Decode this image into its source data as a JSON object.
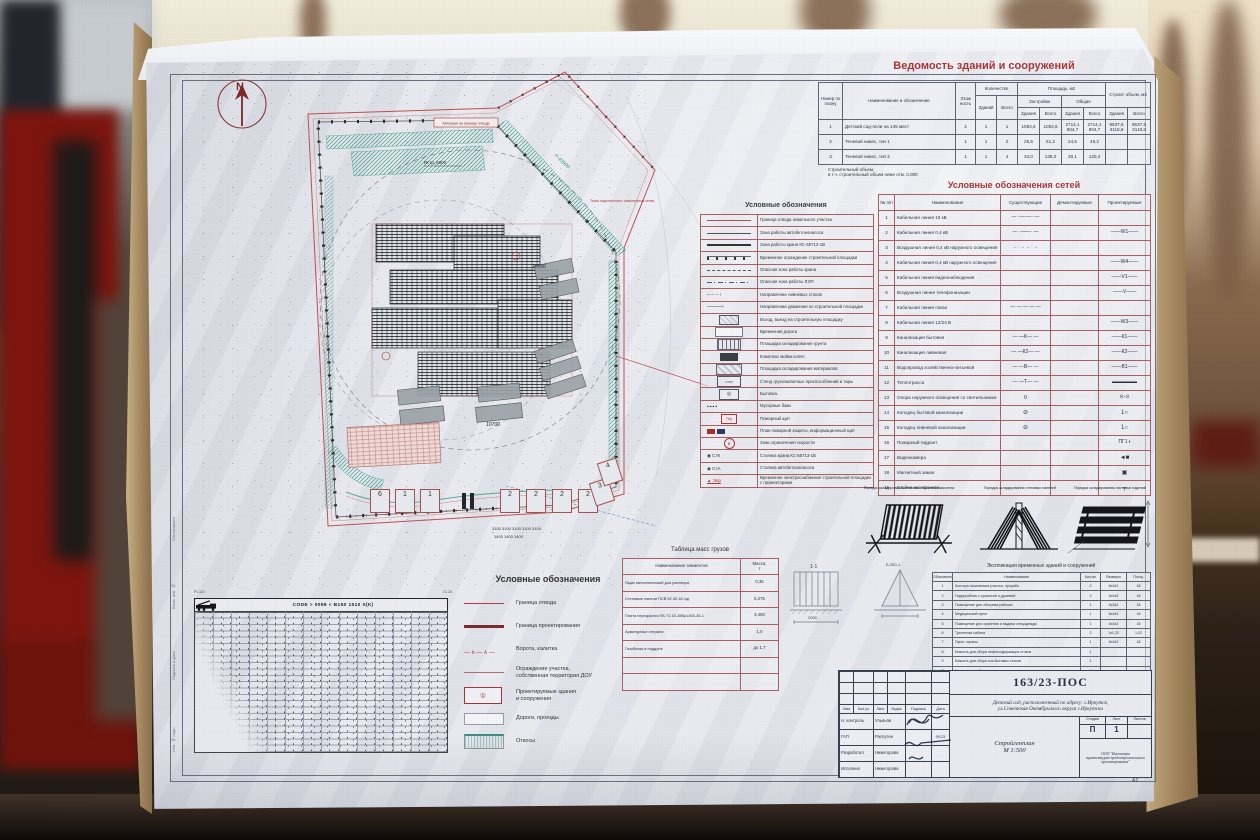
{
  "colors": {
    "accent_red": "#b03434",
    "line_red": "#c0504d",
    "teal": "#2f8f7f",
    "paper": "#e7e9ef"
  },
  "buildings_table": {
    "title": "Ведомость зданий и сооружений",
    "header": {
      "num": "Номер по плану",
      "name": "Наименование и обозначение",
      "floors": "Этаж ность",
      "qty": "Количество",
      "qty_bld": "Зданий",
      "qty_all": "Всего",
      "area": "Площадь, м2",
      "area_built": "Застройки",
      "area_total": "Общая",
      "bld": "Здания",
      "all": "Всего",
      "vol": "Строит. объем, м3"
    },
    "rows": [
      {
        "n": "1",
        "name": "Детский сад-ясли на 145 мест",
        "fl": "2",
        "qb": "1",
        "qa": "1",
        "zb": "1053,6",
        "za": "1053,6",
        "ob": "2714,1\n904,7",
        "oa": "2714,1\n904,7",
        "vb": "9637,6\n3118,8",
        "va": "9637,6\n3118,8"
      },
      {
        "n": "2",
        "name": "Теневой навес, тип 1",
        "fl": "1",
        "qb": "1",
        "qa": "2",
        "zb": "25,6",
        "za": "51,2",
        "ob": "24,6",
        "oa": "49,2",
        "vb": "",
        "va": ""
      },
      {
        "n": "3",
        "name": "Теневой навес, тип 2",
        "fl": "1",
        "qb": "1",
        "qa": "4",
        "zb": "34,0",
        "za": "136,0",
        "ob": "30,1",
        "oa": "120,4",
        "vb": "",
        "va": ""
      }
    ],
    "note": "Строительный объем,\nв т.ч. строительный объем ниже отм. 0.000"
  },
  "networks_table": {
    "title": "Условные обозначения сетей",
    "header": {
      "n": "№ п/п",
      "name": "Наименование",
      "ex": "Существующие",
      "dem": "Демонтируемые",
      "pr": "Проектируемые"
    },
    "rows": [
      {
        "n": "1",
        "name": "Кабельная линия 10 кВ",
        "ex": "— ·—·—· —",
        "pr": ""
      },
      {
        "n": "2",
        "name": "Кабельная линия 0,4 кВ",
        "ex": "— ·——· —",
        "pr": "——W1——"
      },
      {
        "n": "3",
        "name": "Воздушная линия 0,4 кВ наружного освещения",
        "ex": "←·→  ←·→",
        "pr": ""
      },
      {
        "n": "4",
        "name": "Кабельная линия 0,4 кВ наружного освещения",
        "ex": "",
        "pr": "——W4——"
      },
      {
        "n": "5",
        "name": "Кабельная линия видеонаблюдения",
        "ex": "",
        "pr": "——V1——"
      },
      {
        "n": "6",
        "name": "Воздушная линия телефонизации",
        "ex": "",
        "pr": "——V——"
      },
      {
        "n": "7",
        "name": "Кабельная линия связи",
        "ex": "— — — — —",
        "pr": ""
      },
      {
        "n": "8",
        "name": "Кабельная линия 12/24 В",
        "ex": "",
        "pr": "——W3——"
      },
      {
        "n": "9",
        "name": "Канализация бытовая",
        "ex": "— —К— —",
        "pr": "——К1——"
      },
      {
        "n": "10",
        "name": "Канализация ливневая",
        "ex": "— —К2— —",
        "pr": "——К2——"
      },
      {
        "n": "11",
        "name": "Водопровод хозяйственно-питьевой",
        "ex": "— —В— —",
        "pr": "——В1——"
      },
      {
        "n": "12",
        "name": "Теплотрасса",
        "ex": "— —Т— —",
        "pr": "▬▬▬▬▬",
        "prc": "pr-red"
      },
      {
        "n": "13",
        "name": "Опора наружного освещения со светильником",
        "ex": "¤",
        "exc": "ex-dark",
        "pr": "⊙-⊙",
        "prc": "pr-red"
      },
      {
        "n": "14",
        "name": "Колодец бытовой канализации",
        "ex": "⊘",
        "exc": "ex-dark",
        "pr": "1○",
        "prc": "pr-dark"
      },
      {
        "n": "15",
        "name": "Колодец ливневой канализации",
        "ex": "⊖",
        "exc": "ex-dark",
        "pr": "1○",
        "prc": "pr-dark"
      },
      {
        "n": "16",
        "name": "Пожарный гидрант",
        "ex": "",
        "pr": "ПГ1◑",
        "prc": "pr-red"
      },
      {
        "n": "17",
        "name": "Видеокамера",
        "ex": "",
        "pr": "◄■",
        "prc": "pr-dark"
      },
      {
        "n": "18",
        "name": "Магнитный замок",
        "ex": "",
        "pr": "▣",
        "prc": "pr-dark"
      },
      {
        "n": "19",
        "name": "Стойка телефонная",
        "ex": "",
        "pr": "┬",
        "prc": "pr-dark"
      }
    ]
  },
  "legend_main": {
    "title": "Условные обозначения",
    "items": [
      {
        "label": "Граница отвода земельного участка",
        "sym": "s-line-red"
      },
      {
        "label": "Зона работы автобетононасоса",
        "sym": "s-line-solid"
      },
      {
        "label": "Зона работы крана КС-55713-1В",
        "sym": "s-line-thick"
      },
      {
        "label": "Временное ограждение строительной площадки",
        "sym": "s-line-dots"
      },
      {
        "label": "Опасная зона работы крана",
        "sym": "s-line-dash"
      },
      {
        "label": "Опасная зона работы ЛЭП",
        "sym": "s-line-dashdot"
      },
      {
        "label": "Направление ливневых стоков",
        "sym": "s-arrow-dash"
      },
      {
        "label": "Направление движения по строительной площадке",
        "sym": "s-arrow"
      },
      {
        "label": "Въезд, выезд на строительную площадку",
        "sym": "s-gate"
      },
      {
        "label": "Временная дорога",
        "sym": "s-road"
      },
      {
        "label": "Площадка складирования грунта",
        "sym": "s-soil"
      },
      {
        "label": "Комплекс мойки колёс",
        "sym": "s-wash"
      },
      {
        "label": "Площадка складирования материалов",
        "sym": "s-mat"
      },
      {
        "label": "Стенд грузозахватных приспособлений и тары",
        "sym": "s-stand",
        "symtext": "СТЗП"
      },
      {
        "label": "Бытовка",
        "sym": "s-byt",
        "symtext": "◎"
      },
      {
        "label": "Мусорные баки",
        "sym": "s-trash",
        "symtext": "▪▪▪▪"
      },
      {
        "label": "Пожарный щит",
        "sym": "s-fire",
        "symtext": "ПЩ"
      },
      {
        "label": "План пожарной защиты, информационный щит",
        "sym": "s-info"
      },
      {
        "label": "Знак ограничения скорости",
        "sym": "s-speed",
        "symtext": "5"
      },
      {
        "label": "Стоянка крана КС-55713-1В",
        "sym": "s-stk",
        "symtext": "◉  СтК"
      },
      {
        "label": "Стоянка автобетононасоса",
        "sym": "s-sta",
        "symtext": "◉  СтА"
      },
      {
        "label": "Временное электроснабжение строительной площадки с прожекторами",
        "sym": "s-epr",
        "symtext": "▲ Эпр"
      }
    ]
  },
  "mass_table": {
    "title": "Таблица масс грузов",
    "header": {
      "name": "Наименование  элементов",
      "mass": "Масса,\nт"
    },
    "rows": [
      {
        "name": "Ящик металлический  для раствора",
        "mass": "0,35"
      },
      {
        "name": "Стеновые панели ПСВ 52.30.16-1дг",
        "mass": "6,275"
      },
      {
        "name": "Плита перекрытия ПБ 72.15-15Вр1400-35-1",
        "mass": "3,450"
      },
      {
        "name": "Арматурные стержни",
        "mass": "1,0"
      },
      {
        "name": "Газоблоки в поддоне",
        "mass": "до 1,7"
      },
      {
        "name": "",
        "mass": ""
      },
      {
        "name": "",
        "mass": ""
      }
    ]
  },
  "explication_table": {
    "title": "Экспликация временных зданий и сооружений",
    "header": {
      "n": "Обозначение",
      "name": "Наименование",
      "qty": "Кол-во",
      "size": "Размеры",
      "area": "Площ."
    },
    "rows": [
      {
        "n": "1",
        "name": "Контора начальника участка, прораба",
        "qty": "2",
        "size": "6х3х3",
        "area": "18"
      },
      {
        "n": "2",
        "name": "Гардеробная с сушилкой и душевой",
        "qty": "3",
        "size": "6х3х3",
        "area": "18"
      },
      {
        "n": "3",
        "name": "Помещение для обогрева рабочих",
        "qty": "1",
        "size": "6х3х3",
        "area": "18"
      },
      {
        "n": "4",
        "name": "Медицинский пункт",
        "qty": "1",
        "size": "6х3х3",
        "area": "18"
      },
      {
        "n": "5",
        "name": "Помещение для хранения и выдачи спецодежды",
        "qty": "1",
        "size": "6х3х3",
        "area": "18"
      },
      {
        "n": "6",
        "name": "Туалетная кабина",
        "qty": "2",
        "size": "1х1,22",
        "area": "1,22"
      },
      {
        "n": "7",
        "name": "Пункт охраны",
        "qty": "1",
        "size": "6х3х3",
        "area": "18"
      },
      {
        "n": "8",
        "name": "Емкость для сбора нефтесодержащих стоков",
        "qty": "1",
        "size": "",
        "area": ""
      },
      {
        "n": "9",
        "name": "Емкость для сбора хоз-бытовых стоков",
        "qty": "1",
        "size": "",
        "area": ""
      },
      {
        "n": "10",
        "name": "Емкость для сбора ливневых стоков",
        "qty": "1",
        "size": "",
        "area": ""
      }
    ]
  },
  "stacking": {
    "captions": [
      {
        "t": "Порядок складирования стеновых панелей в кассетах"
      },
      {
        "t": "Порядок складирования стеновых панелей"
      },
      {
        "t": "Порядок складирования листовых изделий"
      }
    ]
  },
  "legend_site": {
    "title": "Условные обозначения",
    "items": [
      {
        "label": "Граница отвода",
        "sym": "b-line-red"
      },
      {
        "label": "Граница проектирования",
        "sym": "b-line-dark"
      },
      {
        "label": "Ворота, калитка",
        "sym": "b-gate"
      },
      {
        "label": "Ограждение участка,\nсобственная территория ДОУ",
        "sym": "b-fence"
      },
      {
        "label": "Проектируемые здания\nи сооружения",
        "sym": "b-bld",
        "symtext": "①"
      },
      {
        "label": "Дороги, проезды",
        "sym": "b-road"
      },
      {
        "label": "Откосы",
        "sym": "b-slope"
      }
    ]
  },
  "crane_chart": {
    "tl": "РС110",
    "tr": "21.28",
    "header": "CODE > 0098 <   В150 1510 Х(К)"
  },
  "sketches": {
    "a": "1-1",
    "b": "2000",
    "c": "Б-250-1"
  },
  "margin_labels": [
    {
      "t": "Согласовано"
    },
    {
      "t": "Взам. инв. №"
    },
    {
      "t": "Подпись и дата"
    },
    {
      "t": "Инв. № подл."
    }
  ],
  "title_block": {
    "doc": "163/23-ПОС",
    "project": "Детский сад, расположенный по адресу: г.Иркутск,\nул.Советская Октябрьского округа г.Иркутска",
    "drawing": "Стройгенплан\nМ 1:500",
    "org": "ООО \"Институт\nархитектурно-градостроительного\nпроектирования\"",
    "stage_label": "Стадия",
    "sheet_label": "Лист",
    "sheets_label": "Листов",
    "stage": "П",
    "sheet": "1",
    "sheets": "",
    "cols": {
      "izm": "Изм",
      "kol": "Кол.уч",
      "list": "Лист",
      "doc": "№док",
      "sign": "Подпись",
      "date": "Дата"
    },
    "staff": [
      {
        "role": "Н. контроль",
        "name": "Ульянов",
        "date": ""
      },
      {
        "role": "ГАП",
        "name": "Распутин",
        "date": "09.23"
      },
      {
        "role": "Разработал",
        "name": "Нижегорова",
        "date": ""
      },
      {
        "role": "Исполнил",
        "name": "Нижегорова",
        "date": ""
      }
    ],
    "format": "А2"
  },
  "plan": {
    "north": "N",
    "callout_crane": "Автокран на границе отвода",
    "callout_power": "Точка подключения к инженерным сетям",
    "radius_label": "Rстр. 6000",
    "green_dim": "Р-43900",
    "dim_a": "10700",
    "dim_b": "10700",
    "dims_3100": "3100  3100  3100  3100  3100",
    "dims_1400": "1400      1400      1400",
    "cabins": [
      {
        "n": "6"
      },
      {
        "n": "1"
      },
      {
        "n": "1"
      },
      {
        "n": "2"
      },
      {
        "n": "2"
      },
      {
        "n": "2"
      },
      {
        "n": "2"
      },
      {
        "n": "3"
      },
      {
        "n": "4"
      }
    ]
  }
}
